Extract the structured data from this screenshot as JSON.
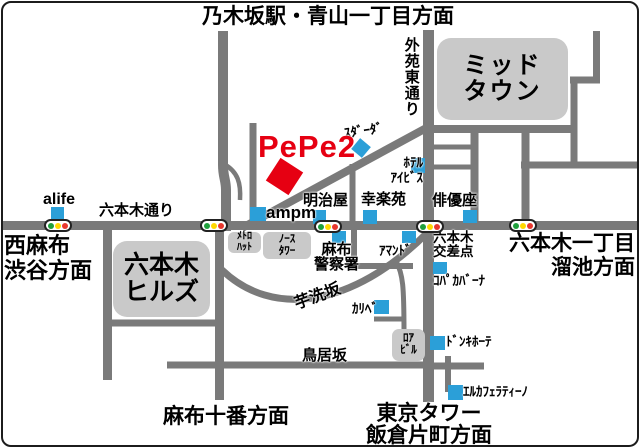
{
  "colors": {
    "road": "#7a7a7a",
    "building_gray": "#c9c9c9",
    "marker_blue": "#2b9fd8",
    "accent_red": "#e60012",
    "signal_green": "#1fa03c",
    "signal_yellow": "#ffd800",
    "signal_red": "#e8382f"
  },
  "destination": {
    "label": "PePe2"
  },
  "directions": {
    "top": "乃木坂駅・青山一丁目方面",
    "west": {
      "line1": "西麻布",
      "line2": "渋谷方面"
    },
    "east": {
      "line1": "六本木一丁目",
      "line2": "溜池方面"
    },
    "south_west": "麻布十番方面",
    "south_east": {
      "line1": "東京タワー",
      "line2": "飯倉片町方面"
    }
  },
  "roads": {
    "roppongi_dori": "六本木通り",
    "gaien_higashi_dori": "外苑東通り",
    "imoarai_zaka": "芋洗坂",
    "torii_zaka": "鳥居坂",
    "roppongi_crossing": {
      "line1": "六本木",
      "line2": "交差点"
    }
  },
  "buildings": {
    "midtown": {
      "line1": "ミッド",
      "line2": "タウン"
    },
    "roppongi_hills": {
      "line1": "六本木",
      "line2": "ヒルズ"
    },
    "metro_hat": {
      "line1": "ﾒﾄﾛ",
      "line2": "ﾊｯﾄ"
    },
    "north_tower": {
      "line1": "ﾉｰｽ",
      "line2": "ﾀﾜｰ"
    },
    "roa_building": {
      "line1": "ﾛｱ",
      "line2": "ﾋﾞﾙ"
    }
  },
  "landmarks": {
    "alife": "alife",
    "ampm": "ampm",
    "meijiya": "明治屋",
    "kourakuen": "幸楽苑",
    "stardust": "ｽﾀﾞｰﾀﾞ",
    "hotel_ibis": {
      "line1": "ﾎﾃﾙ",
      "line2": "ｱｲﾋﾞｽ"
    },
    "haiyuza": "俳優座",
    "azabu_police": {
      "line1": "麻布",
      "line2": "警察署"
    },
    "amand": "ｱﾏﾝﾄﾞ",
    "copacabana": "ｺﾊﾟｶﾊﾞｰﾅ",
    "karibe": "ｶﾘﾍﾞ",
    "don_quijote": "ﾄﾞﾝｷﾎｰﾃ",
    "el_cafe_latino": "ｴﾙｶﾌｪﾗﾃｨｰﾉ"
  }
}
